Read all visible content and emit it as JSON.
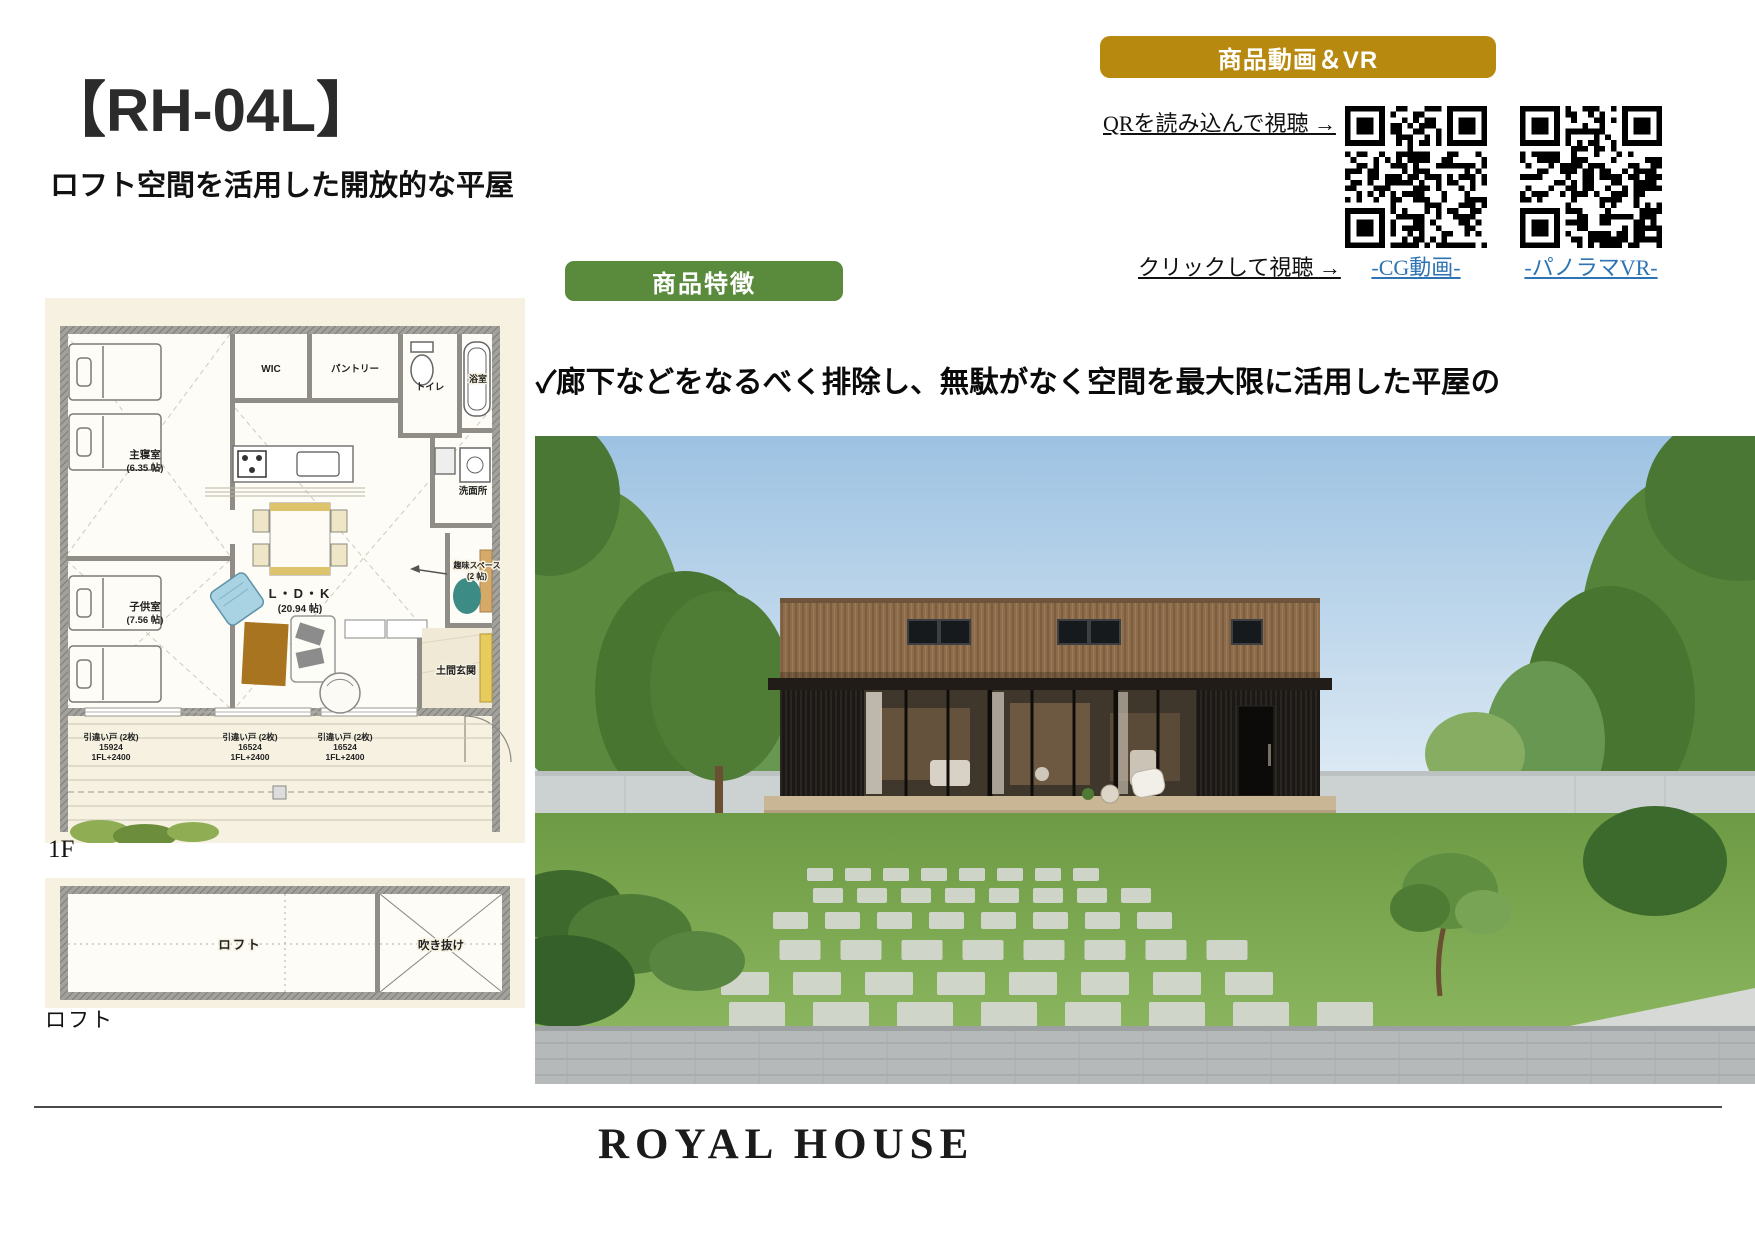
{
  "page": {
    "title": "【RH-04L】",
    "subtitle": "ロフト空間を活用した開放的な平屋"
  },
  "video_vr": {
    "banner": "商品動画＆VR",
    "qr_instruction": "QRを読み込んで視聴 →",
    "click_instruction": "クリックして視聴 →",
    "links": [
      {
        "label": "-CG動画-"
      },
      {
        "label": "-パノラマVR-"
      }
    ]
  },
  "features": {
    "banner": "商品特徴",
    "items": [
      {
        "line1": "✓廊下などをなるべく排除し、無駄がなく空間を最大限に活用した平屋の",
        "line2": "　デザイン。ロフト空間も活用で暮らしの幅も広がります。"
      },
      {
        "line1": "✓広い開口空間で室内は明るく、また外部デッキとの繋がりで暮らしを",
        "line2": "　豊かに演出します。"
      }
    ]
  },
  "floor_plan": {
    "caption_1f": "1F",
    "caption_loft": "ロフト",
    "rooms": {
      "master": "主寝室",
      "master_size": "(6.35 帖)",
      "wic": "WIC",
      "pantry": "パントリー",
      "toilet": "トイレ",
      "bath": "浴室",
      "wash": "洗面所",
      "ldk": "L・D・K",
      "ldk_size": "(20.94 帖)",
      "kids": "子供室",
      "kids_size": "(7.56 帖)",
      "hobby": "趣味スペース",
      "hobby_size": "(2 帖)",
      "doma": "土間玄関",
      "loft": "ロフト",
      "void": "吹き抜け"
    },
    "annotations": [
      {
        "name": "引違い戸 (2枚)",
        "code": "15924",
        "level": "1FL+2400"
      },
      {
        "name": "引違い戸 (2枚)",
        "code": "16524",
        "level": "1FL+2400"
      },
      {
        "name": "引違い戸 (2枚)",
        "code": "16524",
        "level": "1FL+2400"
      }
    ]
  },
  "footer": {
    "logo": "ROYAL HOUSE"
  },
  "colors": {
    "accent_gold": "#b7890f",
    "accent_green": "#5a8b3d",
    "link_blue": "#2e74b5"
  }
}
